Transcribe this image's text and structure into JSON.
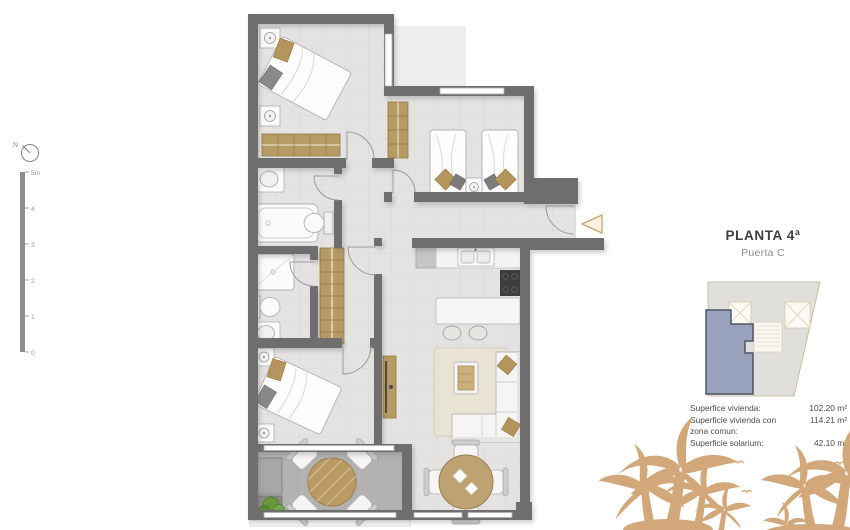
{
  "header": {
    "title": "PLANTA 4ª",
    "subtitle": "Puerta C"
  },
  "compass": {
    "label": "N"
  },
  "scale": {
    "labels": [
      "5m",
      "4",
      "3",
      "2",
      "1",
      "0"
    ]
  },
  "areas": {
    "rows": [
      {
        "label": "Superfice vivienda:",
        "label2": "",
        "value": "102.20 m²"
      },
      {
        "label": "Superficie vivienda con",
        "label2": "zona comun:",
        "value": "114.21 m²"
      },
      {
        "label": "Superficie solarium:",
        "label2": "",
        "value": "42.10 m²"
      }
    ]
  },
  "icons": {
    "compass": "north-compass-icon",
    "entrance": "entrance-arrow-left-icon",
    "decoration": "palm-trees-and-birds"
  },
  "colors": {
    "wall": "#6e6e6e",
    "floor": "#e4e3e1",
    "terrace_floor": "#b3b2b0",
    "wood": "#b79b64",
    "accent_tan": "#d2a87a",
    "unit_fill": "#99a2bc",
    "unit_border": "#4f5663"
  }
}
